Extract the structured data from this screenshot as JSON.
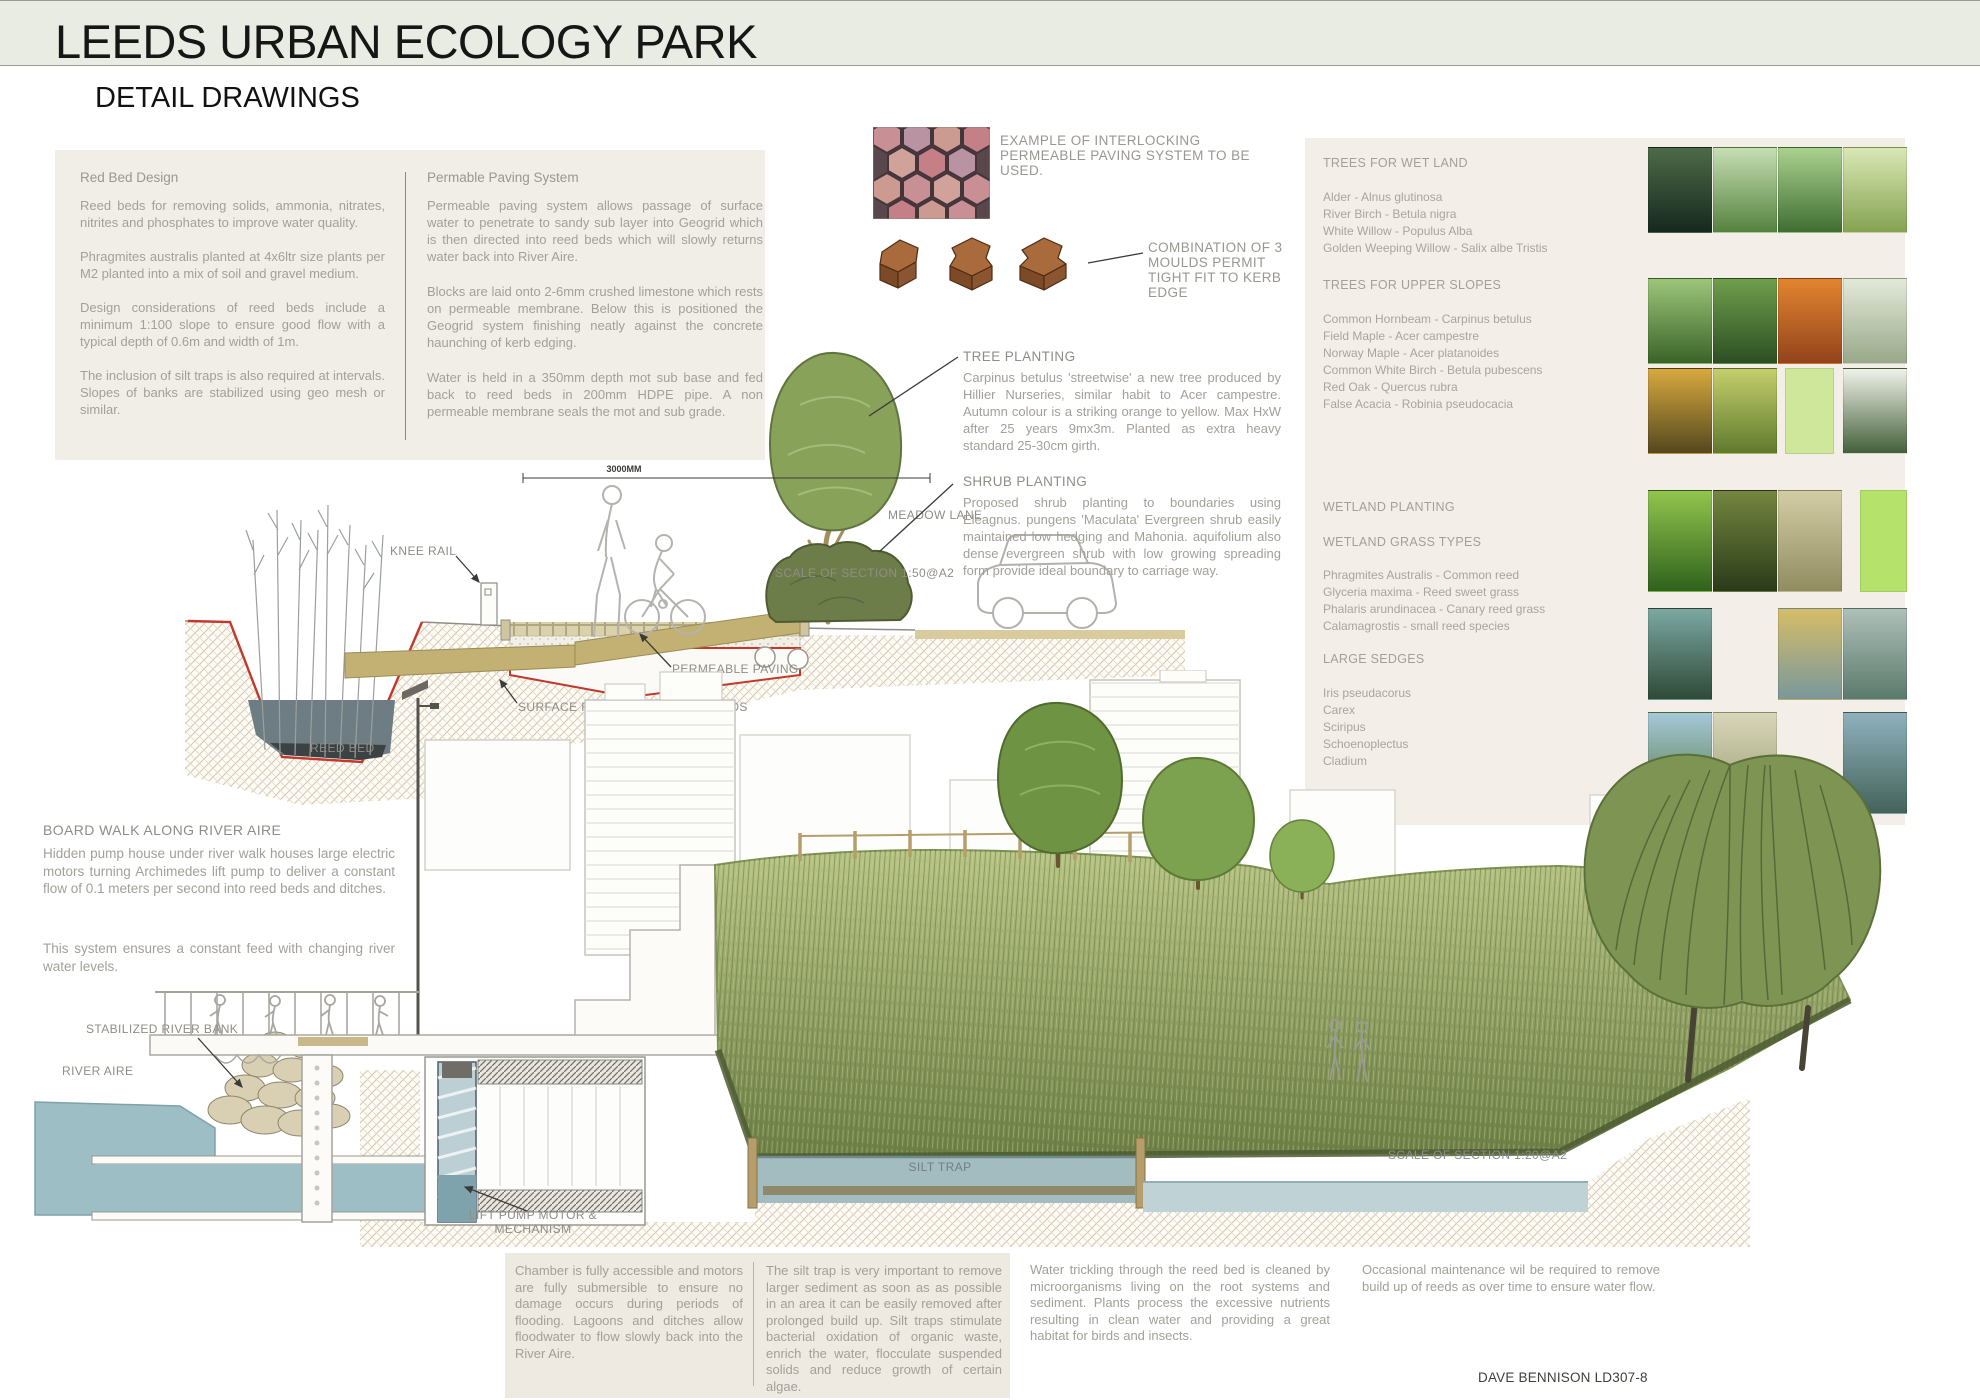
{
  "page": {
    "title": "LEEDS URBAN ECOLOGY PARK",
    "subtitle": "DETAIL DRAWINGS",
    "credit": "DAVE BENNISON LD307-8"
  },
  "colors": {
    "banner_bg": "#e9ece3",
    "panel_bg": "#f1ede7",
    "notes_bg": "#eee9e1",
    "text_grey": "#a3a09a",
    "label_grey": "#8f8d87",
    "accent_red": "#c2382a",
    "water_blue": "#9cbec4",
    "grass_green": "#8fa35e"
  },
  "info_panel": {
    "col1": {
      "heading": "Red Bed Design",
      "paragraphs": [
        "Reed beds for removing solids, ammonia, nitrates, nitrites and phosphates to improve water quality.",
        "Phragmites australis planted at 4x6ltr size plants per M2 planted into a mix of soil and gravel medium.",
        "Design considerations of reed beds include a minimum 1:100 slope to ensure good flow with a typical depth of 0.6m and width of 1m.",
        "The inclusion of silt traps is also required at intervals. Slopes of banks are stabilized using geo mesh or similar."
      ]
    },
    "col2": {
      "heading": "Permable Paving System",
      "paragraphs": [
        "Permeable paving system allows passage of surface water to penetrate to sandy sub layer into Geogrid which is then directed into reed beds which will slowly returns water back into River Aire.",
        "Blocks are laid onto 2-6mm crushed limestone which rests on permeable membrane. Below this is positioned the Geogrid system finishing neatly against the concrete haunching of kerb edging.",
        "Water is held in a 350mm depth mot sub base and fed back to reed beds in 200mm HDPE pipe. A non permeable membrane seals the mot and sub grade."
      ]
    }
  },
  "paving": {
    "example_label": "EXAMPLE OF INTERLOCKING PERMEABLE PAVING SYSTEM TO BE USED.",
    "moulds_label": "COMBINATION OF 3 MOULDS PERMIT TIGHT FIT TO KERB EDGE"
  },
  "section50": {
    "dim": "3000MM",
    "labels": {
      "knee_rail": "KNEE RAIL",
      "reed_bed": "REED BED",
      "runoff": "SURFACE RUN OFF BACK INTO SUDS",
      "permeable": "PERMEABLE PAVING",
      "meadow": "MEADOW LANE",
      "scale": "SCALE OF SECTION 1:50@A2"
    },
    "tree": {
      "heading": "TREE PLANTING",
      "body": "Carpinus betulus 'streetwise' a new tree produced by Hillier Nurseries, similar habit to Acer campestre. Autumn colour is a striking orange to yellow. Max HxW after 25 years 9mx3m. Planted as extra heavy standard 25-30cm girth."
    },
    "shrub": {
      "heading": "SHRUB PLANTING",
      "body": "Proposed shrub planting to boundaries using Eleagnus. pungens 'Maculata' Evergreen shrub easily maintained low hedging and Mahonia. aquifolium also dense evergreen shrub with low growing spreading form provide ideal boundary to carriage way."
    }
  },
  "plant_panel": {
    "sections": [
      {
        "heading": "TREES FOR WET LAND",
        "items": [
          "Alder - Alnus glutinosa",
          "River Birch - Betula nigra",
          "White Willow - Populus Alba",
          "Golden Weeping Willow - Salix albe Tristis"
        ]
      },
      {
        "heading": "TREES FOR UPPER SLOPES",
        "items": [
          "Common Hornbeam - Carpinus betulus",
          "Field Maple - Acer campestre",
          "Norway Maple - Acer platanoides",
          "Common White Birch - Betula pubescens",
          "Red Oak - Quercus rubra",
          "False Acacia - Robinia pseudocacia"
        ]
      },
      {
        "heading": "WETLAND PLANTING",
        "items": []
      },
      {
        "heading": "WETLAND GRASS TYPES",
        "items": [
          "Phragmites Australis - Common reed",
          "Glyceria maxima - Reed sweet grass",
          "Phalaris arundinacea - Canary reed grass",
          "Calamagrostis - small reed species"
        ]
      },
      {
        "heading": "LARGE SEDGES",
        "items": [
          "Iris pseudacorus",
          "Carex",
          "Sciripus",
          "Schoenoplectus",
          "Cladium"
        ]
      }
    ],
    "photos": [
      {
        "name": "alder-wetland-photo",
        "colors": {
          "top": "#4c6b48",
          "bottom": "#17281e"
        }
      },
      {
        "name": "river-birch-photo",
        "colors": {
          "top": "#c6dfb4",
          "bottom": "#55823e"
        }
      },
      {
        "name": "white-willow-photo",
        "colors": {
          "top": "#abd18e",
          "bottom": "#3f6e33"
        }
      },
      {
        "name": "weeping-willow-photo",
        "colors": {
          "top": "#d9e8b5",
          "bottom": "#85a351"
        }
      },
      {
        "name": "hornbeam-photo",
        "colors": {
          "top": "#9dc57a",
          "bottom": "#3a6428"
        }
      },
      {
        "name": "field-maple-photo",
        "colors": {
          "top": "#6f9e4c",
          "bottom": "#2c4f22"
        }
      },
      {
        "name": "norway-maple-autumn-photo",
        "colors": {
          "top": "#e2852f",
          "bottom": "#93431c"
        }
      },
      {
        "name": "white-birch-photo",
        "colors": {
          "top": "#e3e9da",
          "bottom": "#98a888"
        }
      },
      {
        "name": "red-oak-autumn-photo",
        "colors": {
          "top": "#d8a93e",
          "bottom": "#54481f"
        }
      },
      {
        "name": "false-acacia-photo",
        "colors": {
          "top": "#c5cf6b",
          "bottom": "#5f7a2e"
        }
      },
      {
        "name": "green-swatch",
        "colors": {
          "solid": "#cfe79b"
        }
      },
      {
        "name": "blossom-photo",
        "colors": {
          "top": "#f0f2e9",
          "bottom": "#44603a"
        }
      },
      {
        "name": "iris-leaves-photo",
        "colors": {
          "top": "#93c44e",
          "bottom": "#2f621c"
        }
      },
      {
        "name": "common-reed-photo",
        "colors": {
          "top": "#74863f",
          "bottom": "#2a3a19"
        }
      },
      {
        "name": "dry-grass-photo",
        "colors": {
          "top": "#d3cda5",
          "bottom": "#908c60"
        }
      },
      {
        "name": "bright-green-swatch",
        "colors": {
          "solid": "#b5e26b"
        }
      },
      {
        "name": "pond-photo",
        "colors": {
          "top": "#7ba8a2",
          "bottom": "#2f4a38"
        }
      },
      {
        "name": "golden-reeds-photo",
        "colors": {
          "top": "#d6bd67",
          "bottom": "#79989c"
        }
      },
      {
        "name": "marsh-photo",
        "colors": {
          "top": "#aec0b8",
          "bottom": "#5b7a6c"
        }
      },
      {
        "name": "reeds-sky-photo",
        "colors": {
          "top": "#a5c8da",
          "bottom": "#4f7436"
        }
      },
      {
        "name": "pale-reeds-photo",
        "colors": {
          "top": "#d8d6b8",
          "bottom": "#9a9a72"
        }
      },
      {
        "name": "river-bank-photo",
        "colors": {
          "top": "#8fb1bd",
          "bottom": "#44635a"
        }
      }
    ]
  },
  "boardwalk": {
    "heading": "BOARD WALK ALONG RIVER AIRE",
    "paragraphs": [
      "Hidden pump house under river walk houses large electric motors turning Archimedes lift pump to deliver a constant flow of 0.1 meters per second into reed beds and ditches.",
      "This system ensures a constant feed with changing river water levels."
    ]
  },
  "section20": {
    "labels": {
      "stabilized": "STABILIZED RIVER BANK",
      "river": "RIVER AIRE",
      "lift_pump": "LIFT PUMP MOTOR & MECHANISM",
      "silt": "SILT TRAP",
      "scale": "SCALE OF SECTION 1:20@A2"
    }
  },
  "notes": {
    "chamber": "Chamber is fully accessible and motors are fully submersible to ensure no damage occurs during periods of flooding. Lagoons and ditches allow floodwater to flow slowly back into the River Aire.",
    "silt": "The silt trap is very important to remove larger sediment as soon as as possible in an area it can be easily removed after prolonged build up. Silt traps stimulate bacterial oxidation of organic waste, enrich the water, flocculate suspended solids and reduce growth of certain algae.",
    "water": "Water trickling through the reed bed is cleaned by microorganisms living on the root systems and sediment. Plants process the excessive nutrients resulting in clean water and providing a great habitat for birds and insects.",
    "maintenance": "Occasional maintenance wil be required to remove build up of reeds as over time to ensure water flow."
  }
}
